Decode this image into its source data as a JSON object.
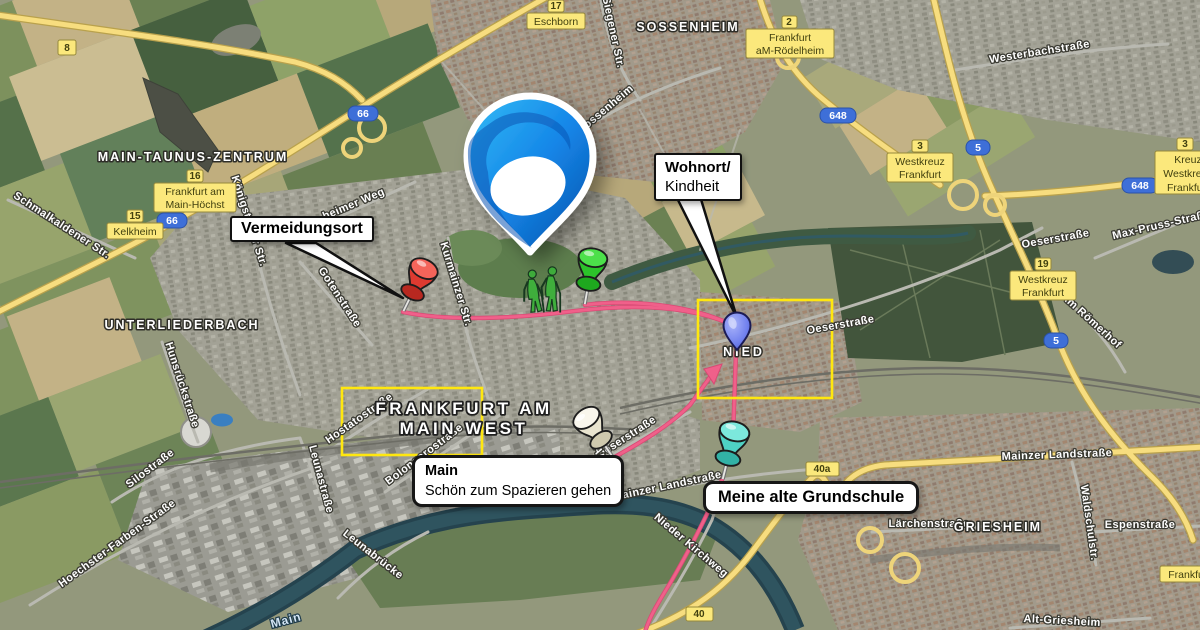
{
  "map": {
    "place_labels": [
      "MAIN-TAUNUS-ZENTRUM",
      "SOSSENHEIM",
      "UNTERLIEDERBACH",
      "GRIESHEIM",
      "NIED"
    ],
    "region_boxes": {
      "frankfurt_west": {
        "line1": "FRANKFURT AM",
        "line2": "MAIN WEST"
      }
    },
    "street_labels": [
      "Schmalkaldener Str.",
      "Königsteiner Str.",
      "heimer Weg",
      "Kurmainzer Str.",
      "Gotenstraße",
      "Siegener Str.",
      "Alt-Sossenheim",
      "Westerbachstraße",
      "Max-Pruss-Straße",
      "Oeserstraße",
      "Oeserstraße",
      "Oeserstraße",
      "Am Römerhof",
      "Mainzer Landstraße",
      "Mainzer Landstraße",
      "Nieder Kirchweg",
      "Alt-Nied",
      "Lärchenstraße",
      "Espenstraße",
      "Waldschulstr.",
      "Alt-Griesheim",
      "Hunsrückstraße",
      "Silostraße",
      "Hoechster-Farben-Straße",
      "Leunastraße",
      "Leunabrücke",
      "Hostatostraße",
      "Bolongarostraße",
      "Main"
    ],
    "shields": [
      "8",
      "66",
      "66",
      "648",
      "648",
      "5",
      "5",
      "40",
      "40a"
    ],
    "exits": [
      {
        "lines": [
          "17",
          "Eschborn"
        ]
      },
      {
        "lines": [
          "2",
          "Frankfurt",
          "aM-Rödelheim"
        ]
      },
      {
        "lines": [
          "16",
          "Frankfurt am",
          "Main-Höchst"
        ]
      },
      {
        "lines": [
          "15",
          "Kelkheim"
        ]
      },
      {
        "lines": [
          "3",
          "Westkreuz",
          "Frankfurt"
        ]
      },
      {
        "lines": [
          "3",
          "Kreuz",
          "Westkreuz",
          "Frankfurt"
        ]
      },
      {
        "lines": [
          "19",
          "Westkreuz",
          "Frankfurt"
        ]
      },
      {
        "lines": [
          "Frankfurt-"
        ]
      }
    ],
    "callouts": {
      "vermeidungsort": {
        "text": "Vermeidungsort"
      },
      "wohnort": {
        "line1": "Wohnort/",
        "line2": "Kindheit"
      },
      "main_river": {
        "title": "Main",
        "subtitle": "Schön zum Spazieren gehen"
      },
      "grundschule": {
        "text": "Meine alte Grundschule"
      }
    },
    "colors": {
      "route_pink": "#f0608a",
      "highlight_yellow": "#ffe70f",
      "motorway_shield_blue": "#3e6fd8",
      "exit_badge_yellow": "#fbe87c"
    }
  }
}
